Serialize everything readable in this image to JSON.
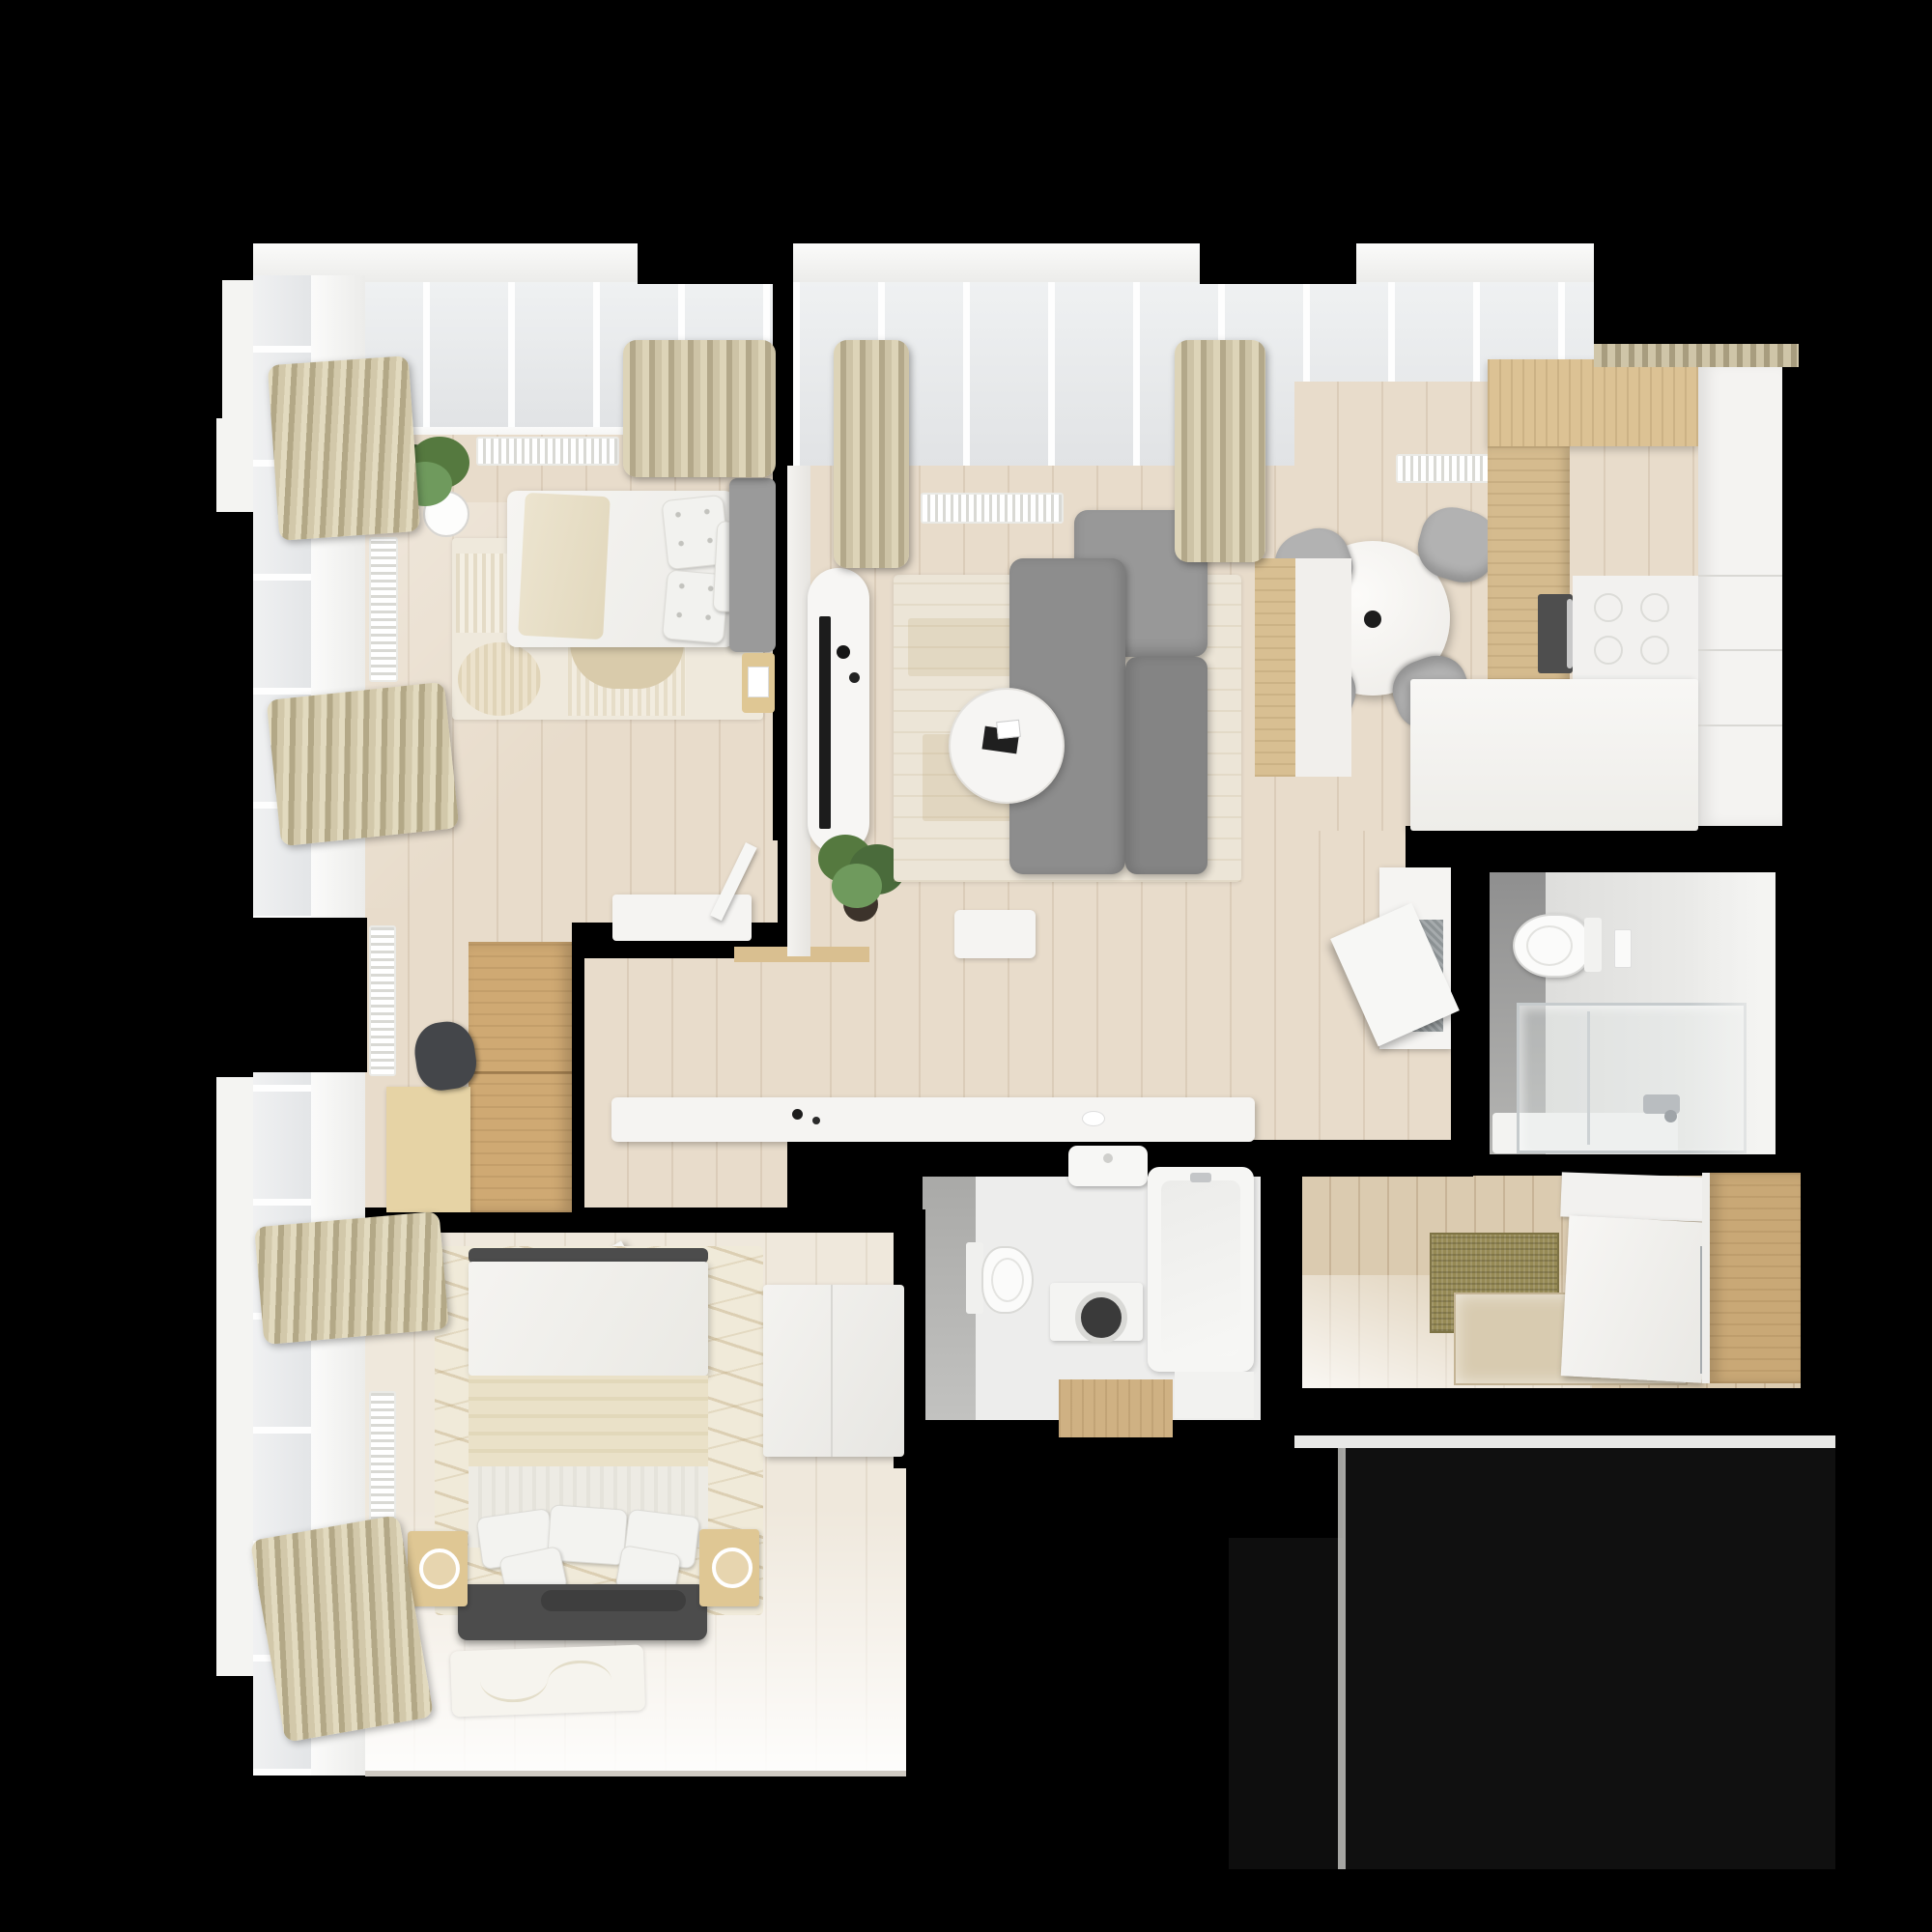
{
  "scene": {
    "kind": "apartment-floor-plan-3d-top-view",
    "background_color": "#000000",
    "no_visible_text": true
  },
  "palette": {
    "wall": "#000000",
    "floor": "#e8dccb",
    "floorBedroom": "#efe8dc",
    "floorEntry": "#dbcbb0",
    "plank": "rgba(150,124,92,0.16)",
    "white": "#f5f4f2",
    "glass": "#e7e9ea",
    "wood": "#cfa973",
    "woodLight": "#e6d3a5",
    "woodKitchen": "#dcc294",
    "woodNightstand": "#dfc794",
    "curtain": "#cdc3a6",
    "curtainDark": "#b3a887",
    "sofa": "#8d8d8d",
    "sofaLight": "#989898",
    "sofaDark": "#848484",
    "chairGray": "#b2b2b2",
    "rugLiving": "#ece5d7",
    "rugAccent": "#d8c9a8",
    "tileGray": "#ababab",
    "tileDark": "#9a9a9a",
    "bathFloor": "#ededec",
    "darkUpholstery": "#4c4c4c",
    "oliveMat": "#968a55",
    "terrace": "#101010",
    "plantGreen": "#55793f",
    "plantGreenDark": "#3c5a2e",
    "tvBlack": "#1c1c1c"
  },
  "rooms": [
    {
      "id": "bedroom-1",
      "area": "top-left",
      "furniture": [
        "potted-plant",
        "single-bed",
        "polka-dot-pillows",
        "gray-headboard",
        "cream-throw",
        "layered-rug",
        "radiators",
        "curtains",
        "white-dresser",
        "side-stool",
        "tall-oak-wardrobe",
        "birch-desk",
        "dark-desk-chair",
        "windows"
      ]
    },
    {
      "id": "living-room",
      "area": "top-center",
      "furniture": [
        "tv-console",
        "tv",
        "decor-rounds",
        "potted-plant",
        "abstract-rug",
        "gray-sectional-sofa",
        "round-coffee-table",
        "round-dining-table",
        "dining-chairs-x4",
        "vase",
        "curtains",
        "radiators",
        "long-white-sideboard",
        "wood-threshold",
        "white-pouf",
        "windows"
      ]
    },
    {
      "id": "kitchen",
      "area": "top-right",
      "furniture": [
        "oak-upper-cabinets",
        "oak-tall-cabinets",
        "built-in-oven",
        "white-cooktop-counter",
        "white-column-cabinet",
        "white-peninsula-counter",
        "oak-bar-strip",
        "cabinet-with-open-door"
      ]
    },
    {
      "id": "bathroom-1",
      "area": "right-middle",
      "furniture": [
        "wall-hung-toilet",
        "flush-plate",
        "glass-shower-enclosure",
        "shower-tray",
        "chrome-shower-set",
        "gray-tile-wall"
      ]
    },
    {
      "id": "bathroom-2",
      "area": "bottom-center",
      "furniture": [
        "wash-basin",
        "wall-hung-toilet",
        "washing-machine",
        "bathtub",
        "wooden-step-mat",
        "white-shelf",
        "gray-tile-wall"
      ]
    },
    {
      "id": "hallway",
      "area": "center",
      "furniture": [
        "long-white-console",
        "open-door-leaf-to-bedroom-2",
        "open-door-leaf-to-bedroom-1"
      ]
    },
    {
      "id": "entry",
      "area": "bottom-right",
      "furniture": [
        "olive-doormat",
        "beige-tile-inset",
        "sliding-wardrobe-doors",
        "door-handle",
        "oak-cabinet"
      ]
    },
    {
      "id": "bedroom-2",
      "area": "bottom-left",
      "furniture": [
        "double-bed",
        "striped-blankets",
        "pillows",
        "dark-upholstered-headboard",
        "bolster",
        "nightstands-x2",
        "white-lamps",
        "wavy-rug",
        "floor-blanket",
        "white-corner-bench",
        "curtains",
        "radiators",
        "windows"
      ]
    },
    {
      "id": "terrace",
      "area": "bottom-right-outside",
      "furniture": [
        "dark-decking"
      ]
    }
  ]
}
